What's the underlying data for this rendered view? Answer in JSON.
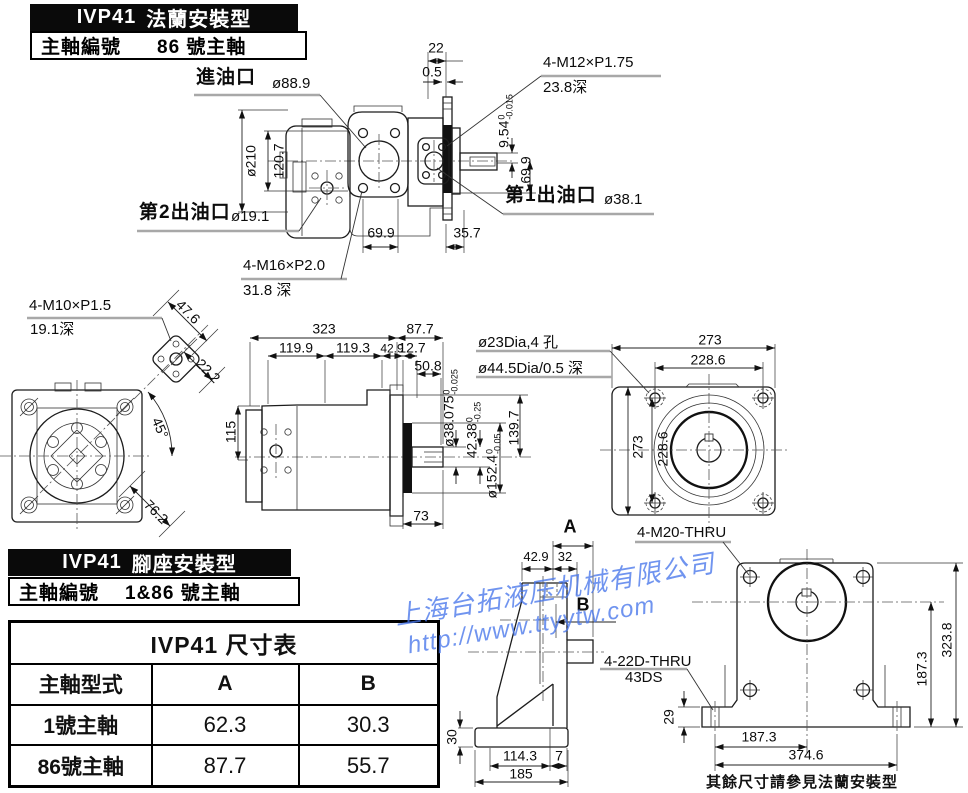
{
  "headers": {
    "flange": {
      "title_model": "IVP41",
      "title_type": "法蘭安裝型",
      "shaft_label": "主軸編號",
      "shaft_value": "86 號主軸"
    },
    "foot": {
      "title_model": "IVP41",
      "title_type": "腳座安裝型",
      "shaft_label": "主軸編號",
      "shaft_value": "1&86 號主軸"
    }
  },
  "table": {
    "title": "IVP41 尺寸表",
    "col_type": "主軸型式",
    "col_a": "A",
    "col_b": "B",
    "rows": [
      {
        "type": "1號主軸",
        "a": "62.3",
        "b": "30.3"
      },
      {
        "type": "86號主軸",
        "a": "87.7",
        "b": "55.7"
      }
    ]
  },
  "watermark": {
    "company": "上海台拓液压机械有限公司",
    "url": "http://www.ttyytw.com",
    "color": "#4876eb"
  },
  "note": "其餘尺寸請參見法蘭安裝型",
  "flange_view": {
    "inlet_label": "進油口",
    "inlet_dia": "ø88.9",
    "outlet1_label": "第1出油口",
    "outlet1_dia": "ø38.1",
    "outlet2_label": "第2出油口",
    "outlet2_dia": "ø19.1",
    "bolt_top": "4-M12×P1.75",
    "bolt_top_depth": "23.8深",
    "bolt_bottom": "4-M16×P2.0",
    "bolt_bottom_depth": "31.8 深",
    "d22": "22",
    "d05": "0.5",
    "d210": "ø210",
    "d120_7": "120.7",
    "d9_54": "9.54",
    "d9_54_tol_top": "0",
    "d9_54_tol_bot": "-0.015",
    "d69_9_right": "69.9",
    "d69_9_bottom": "69.9",
    "d35_7": "35.7"
  },
  "rear_view": {
    "bolt": "4-M10×P1.5",
    "bolt_depth": "19.1深",
    "d47_6": "47.6",
    "d22_2": "22.2",
    "d45": "45°",
    "d76_2": "76.2"
  },
  "side_view": {
    "d323": "323",
    "d87_7": "87.7",
    "d119_9": "119.9",
    "d119_3": "119.3",
    "d42_9": "42.9",
    "d12_7": "12.7",
    "d50_8": "50.8",
    "d115": "115",
    "d38": "ø38.075",
    "d38_tol_top": "0",
    "d38_tol_bot": "-0.025",
    "d42_38": "42.38",
    "d42_38_tol_top": "0",
    "d42_38_tol_bot": "-0.25",
    "d152_4": "ø152.4",
    "d152_4_tol_top": "0",
    "d152_4_tol_bot": "-0.05",
    "d139_7": "139.7",
    "d73": "73"
  },
  "flange_face_view": {
    "holes": "ø23Dia,4 孔",
    "spigot": "ø44.5Dia/0.5 深",
    "d273_h": "273",
    "d228_6_h": "228.6",
    "d273_v": "273",
    "d228_6_v": "228.6"
  },
  "foot_side_view": {
    "dim_a": "A",
    "dim_b": "B",
    "d42_9": "42.9",
    "d32": "32",
    "d30": "30",
    "d114_3": "114.3",
    "d7": "7",
    "d185": "185"
  },
  "foot_front_view": {
    "bolt": "4-M20-THRU",
    "foot_hole": "4-22D-THRU",
    "foot_hole_code": "43DS",
    "d29": "29",
    "d323_8": "323.8",
    "d187_3_v": "187.3",
    "d187_3_h": "187.3",
    "d374_6": "374.6"
  }
}
